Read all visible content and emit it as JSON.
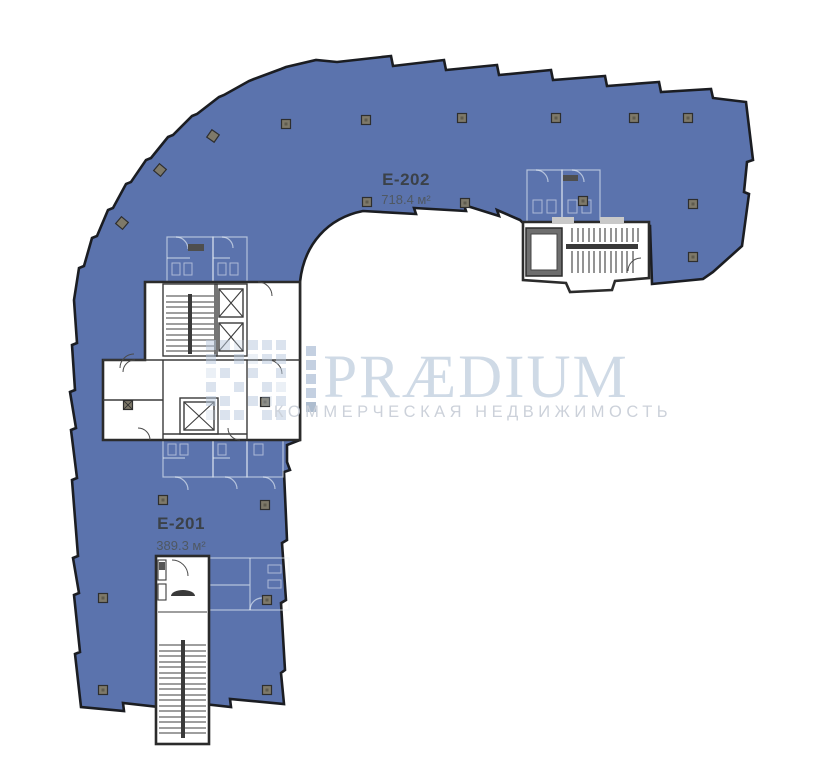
{
  "brand": {
    "name": "PRÆDIUM",
    "tagline": "КОММЕРЧЕСКАЯ НЕДВИЖИМОСТЬ",
    "logo_color": "#ccd7e4",
    "tagline_color": "#c8ced7",
    "mark_color": "#b9c9dd"
  },
  "units": [
    {
      "id": "E-202",
      "area": "718.4 м²"
    },
    {
      "id": "E-201",
      "area": "389.3 м²"
    }
  ],
  "colors": {
    "floor_fill": "#5b73ad",
    "outer_wall": "#1b1d22",
    "core_wall": "#383838",
    "column": "#7e7969",
    "column_inner": "#5f5b4e",
    "unit_label": "#3b4148",
    "unit_area": "#4f5862"
  }
}
